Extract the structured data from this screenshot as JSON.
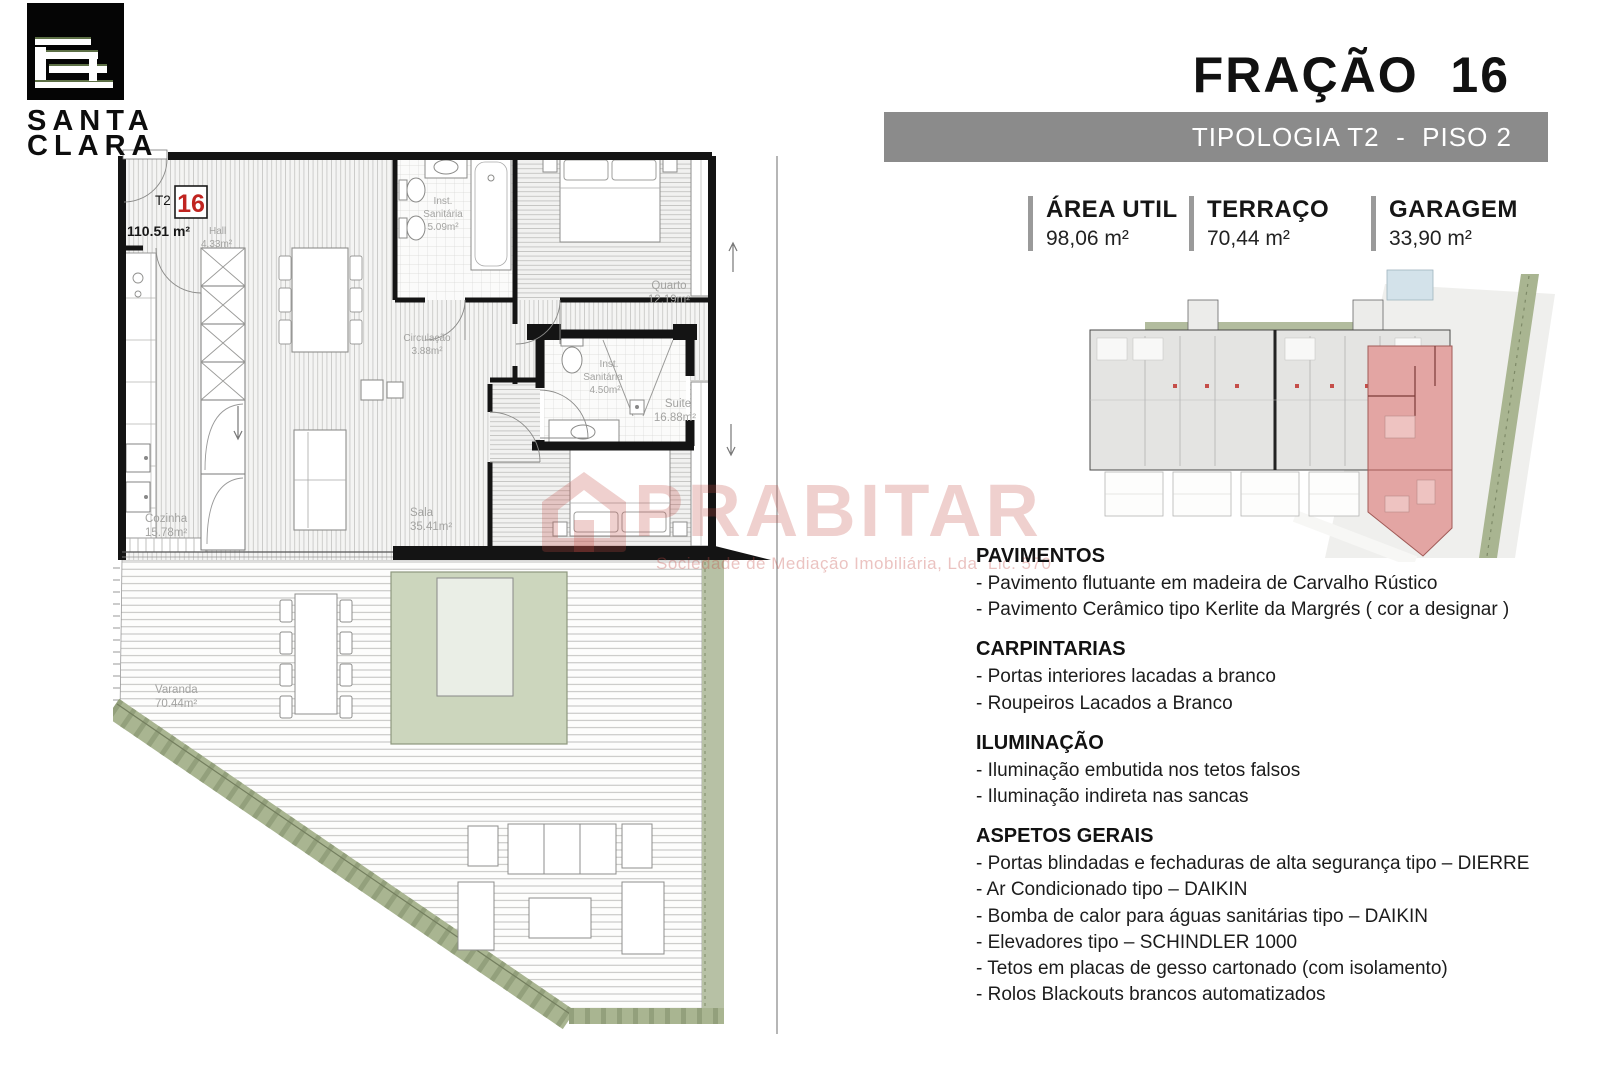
{
  "logo": {
    "line1": "SANTA",
    "line2": "CLARA"
  },
  "header": {
    "title": "FRAÇÃO  16",
    "banner": "TIPOLOGIA T2  -  PISO 2",
    "banner_color": "#8b8b8b"
  },
  "areas": [
    {
      "label": "ÁREA UTIL",
      "value": "98,06 m²"
    },
    {
      "label": "TERRAÇO",
      "value": "70,44 m²"
    },
    {
      "label": "GARAGEM",
      "value": "33,90 m²"
    }
  ],
  "plan": {
    "unit_typology": "T2",
    "unit_number": "16",
    "unit_area": "110.51 m²",
    "labels": {
      "hall": [
        "Hall",
        "4.33m²"
      ],
      "wc1": [
        "Inst.",
        "Sanitária",
        "5.09m²"
      ],
      "quarto": [
        "Quarto",
        "12.19m²"
      ],
      "circulacao": [
        "Circulação",
        "3.88m²"
      ],
      "wc2": [
        "Inst.",
        "Sanitária",
        "4.50m²"
      ],
      "suite": [
        "Suite",
        "16.88m²"
      ],
      "cozinha": [
        "Cozinha",
        "15.78m²"
      ],
      "sala": [
        "Sala",
        "35.41m²"
      ],
      "varanda": [
        "Varanda",
        "70.44m²"
      ]
    }
  },
  "watermark": {
    "name": "PRABITAR",
    "subtitle": "Sociedade de Mediação Imobiliária, Lda  Lic. 570"
  },
  "specs": [
    {
      "heading": "PAVIMENTOS",
      "items": [
        "- Pavimento flutuante em madeira de Carvalho Rústico",
        "- Pavimento Cerâmico tipo Kerlite da Margrés ( cor a designar )"
      ]
    },
    {
      "heading": "CARPINTARIAS",
      "items": [
        "- Portas interiores lacadas a branco",
        "- Roupeiros Lacados a Branco"
      ]
    },
    {
      "heading": "ILUMINAÇÃO",
      "items": [
        "- Iluminação embutida nos tetos falsos",
        "- Iluminação indireta nas sancas"
      ]
    },
    {
      "heading": "ASPETOS GERAIS",
      "items": [
        "- Portas blindadas e fechaduras de alta segurança tipo – DIERRE",
        "- Ar Condicionado tipo – DAIKIN",
        "- Bomba de calor para águas sanitárias tipo – DAIKIN",
        "- Elevadores tipo – SCHINDLER 1000",
        "- Tetos em placas de gesso cartonado (com isolamento)",
        "- Rolos Blackouts brancos automatizados"
      ]
    }
  ],
  "colors": {
    "accent_red": "#c02420",
    "banner_gray": "#8b8b8b",
    "keyplan_highlight": "#e3a5a3",
    "watermark_pink": "#c9514b",
    "planter_green": "#ccd6bd",
    "hedge_green": "#a9b591"
  }
}
